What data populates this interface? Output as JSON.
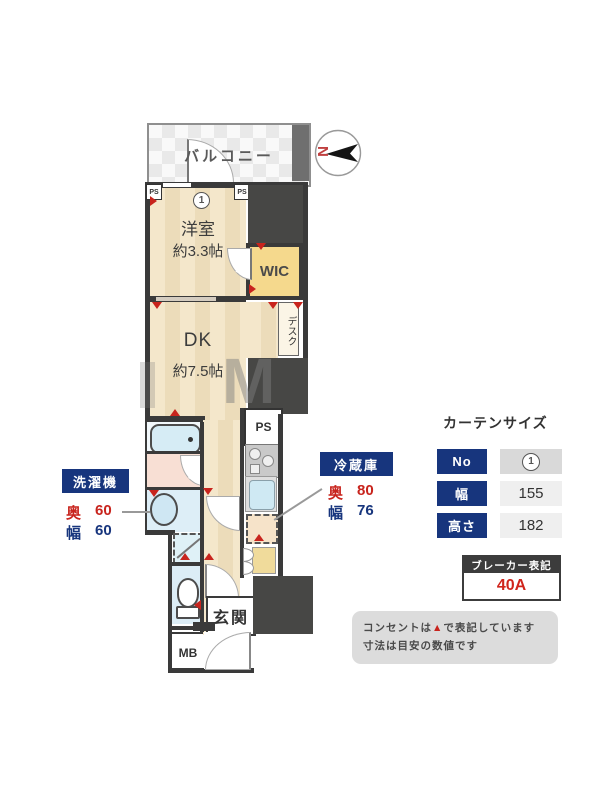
{
  "plan": {
    "balcony": "バルコニー",
    "bedroom": "洋室",
    "bedroom_size": "約3.3帖",
    "marker_no": "1",
    "wic": "WIC",
    "desk": "デスク",
    "dk": "DK",
    "dk_size": "約7.5帖",
    "ps": "PS",
    "genkan": "玄関",
    "mb": "MB",
    "watermark": "M"
  },
  "compass": {
    "north": "N"
  },
  "washer": {
    "title": "洗濯機",
    "depth_label": "奥",
    "depth": "60",
    "width_label": "幅",
    "width": "60"
  },
  "fridge": {
    "title": "冷蔵庫",
    "depth_label": "奥",
    "depth": "80",
    "width_label": "幅",
    "width": "76"
  },
  "curtain": {
    "title": "カーテンサイズ",
    "rows": [
      {
        "label": "No",
        "value": "1"
      },
      {
        "label": "幅",
        "value": "155"
      },
      {
        "label": "高さ",
        "value": "182"
      }
    ]
  },
  "breaker": {
    "title": "ブレーカー表記",
    "value": "40A"
  },
  "notes": {
    "line1_pre": "コンセントは",
    "line1_marker": "▲",
    "line1_post": "で表記しています",
    "line2": "寸法は目安の数値です"
  },
  "colors": {
    "navy": "#17357d",
    "red": "#c8241d",
    "wall": "#3a3a3a",
    "wic_yellow": "#f5d98d"
  }
}
